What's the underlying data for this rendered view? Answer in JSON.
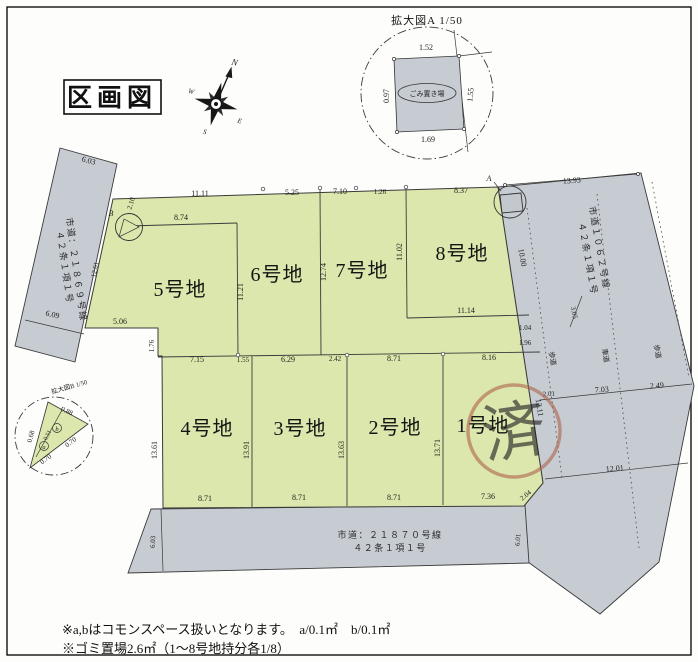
{
  "doc": {
    "title": "区画図"
  },
  "compass": {
    "n": "N",
    "e": "E",
    "s": "S",
    "w": "W"
  },
  "detail_a": {
    "title": "拡大図A 1/50",
    "area_label": "ごみ置き場",
    "dim_top": "1.52",
    "dim_bottom": "1.69",
    "dim_left": "0.97",
    "dim_right": "1.55",
    "callout_label": "A"
  },
  "detail_b": {
    "title": "拡大図B 1/50",
    "dim_top": "0.88",
    "dim_left": "0.68",
    "dim_seg1": "0.70",
    "dim_seg2": "0.70",
    "dim_mid": "0.51",
    "label_a": "a",
    "label_b": "b",
    "callout_label": "B",
    "callout_dim": "2.10"
  },
  "plots": {
    "p5": {
      "name": "5号地"
    },
    "p6": {
      "name": "6号地"
    },
    "p7": {
      "name": "7号地"
    },
    "p8": {
      "name": "8号地"
    },
    "p4": {
      "name": "4号地"
    },
    "p3": {
      "name": "3号地"
    },
    "p2": {
      "name": "2号地"
    },
    "p1": {
      "name": "1号地",
      "stamp": "済"
    }
  },
  "dims": {
    "top": [
      "11.11",
      "5.25",
      "7.10",
      "1.26",
      "8.37"
    ],
    "mid": [
      "7.15",
      "1.55",
      "6.29",
      "2.42",
      "8.71",
      "8.16"
    ],
    "bottom": [
      "8.71",
      "8.71",
      "8.71",
      "7.36"
    ],
    "v_top": [
      "11.21",
      "12.74",
      "11.02",
      "10.00"
    ],
    "v_bottom": [
      "13.61",
      "13.91",
      "13.63",
      "13.71",
      "12.11"
    ],
    "p5": {
      "top": "8.74",
      "step_w": "5.06",
      "step_h": "1.76",
      "slope": "12.61"
    },
    "p8": {
      "bottom": "11.14",
      "edge1": "1.04",
      "edge2": "1.96"
    },
    "corner": "2.04"
  },
  "roads": {
    "left": {
      "name": "市道：２１８６９号線",
      "clause": "４２条１項１号",
      "dim_top": "6.03",
      "dim_bottom": "6.09"
    },
    "right": {
      "name": "市道１０６２号線",
      "clause": "４２条１項１号",
      "dim_top": "13.93",
      "dim_mid": "3.05",
      "dim_cross1": "2.01",
      "dim_cross2": "7.03",
      "dim_cross3": "2.49",
      "dim_lower": "12.01",
      "sidewalk": "歩道",
      "roadway": "車道"
    },
    "bottom": {
      "name": "市道：２１８７０号線",
      "clause": "４２条１項１号",
      "dim_left": "6.03",
      "dim_right": "6.01"
    }
  },
  "notes": [
    "※a,bはコモンスペース扱いとなります。　a/0.1㎡　b/0.1㎡",
    "※ゴミ置場2.6㎡（1～8号地持分各1/8）"
  ],
  "colors": {
    "plot": "#dbe7ac",
    "road": "#c7ccd3",
    "stamp": "#b0674f",
    "line": "#3a3a3a"
  }
}
